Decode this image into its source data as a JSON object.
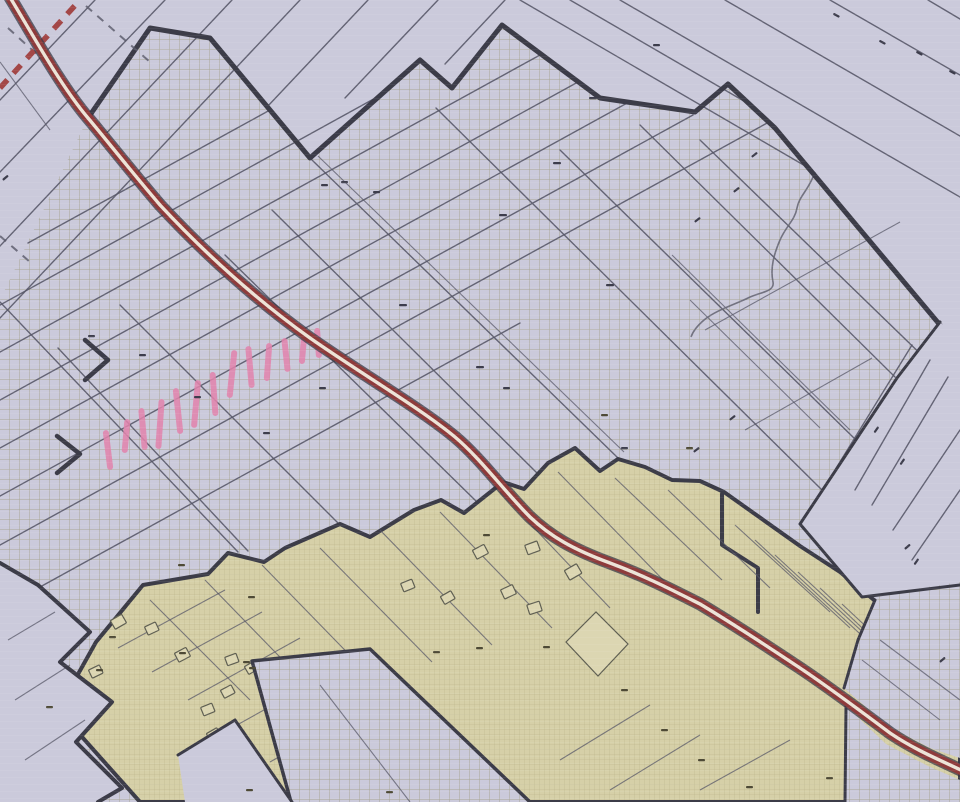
{
  "map": {
    "features": [
      {
        "name": "crosshatch-grid-zone",
        "pattern": "square-grid"
      },
      {
        "name": "built-up-zone",
        "pattern": "fine-grid"
      },
      {
        "name": "main-road",
        "style": "double-red-with-white-center"
      },
      {
        "name": "boundary-dashed-line",
        "style": "red-dashed"
      },
      {
        "name": "pink-highlight-band",
        "style": "marker-hatches",
        "stroke_count": 13
      },
      {
        "name": "stream-line",
        "style": "wavy"
      },
      {
        "name": "building-footprints"
      },
      {
        "name": "parcel-number-marks",
        "note": "illegible at scan resolution"
      }
    ]
  },
  "colors": {
    "bg_lavender": "#cbcadb",
    "grid_olive": "#a5a189",
    "khaki_fill": "#d6d0a8",
    "khaki_grid": "#b8af87",
    "khaki_light": "#dcd6b2",
    "bld_line": "#5f5f52",
    "parcel_line": "#585868",
    "bold_border": "#3c3c48",
    "road_red": "#8e3b3b",
    "road_center": "#ece3d7",
    "road_casing": "#3a3a46",
    "dashed_red": "#a34747",
    "pink": "#e283ab",
    "stream": "#686875",
    "mark_dark": "#3d3d4c",
    "mark_olive": "#4e4a36"
  }
}
